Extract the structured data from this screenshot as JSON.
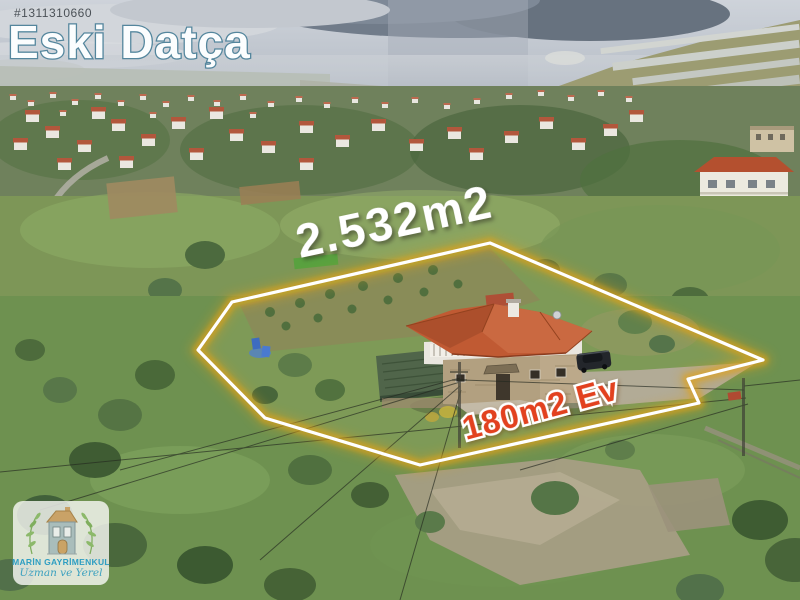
{
  "image": {
    "listing_id": "#1311310660",
    "title": "Eski Datça",
    "land_area": "2.532m2",
    "house_area": "180m2 Ev"
  },
  "logo": {
    "company": "MARİN GAYRİMENKUL",
    "tagline": "Uzman ve Yerel",
    "icon": "house-with-leaves-icon"
  },
  "colors": {
    "title_fill": "#fbfdfe",
    "title_outline": "#54869d",
    "listing_id_text": "#4b5157",
    "land_area_text": "#ffffff",
    "house_area_fill": "#e2411f",
    "house_area_outline": "#ffffff",
    "boundary_line": "#ffffff",
    "boundary_glow": "#e2a217",
    "house_roof": "#c05a33",
    "logo_company_text": "#2e9ec2",
    "logo_tagline_text": "#3aa0bf",
    "sky": "#c9ced6"
  }
}
